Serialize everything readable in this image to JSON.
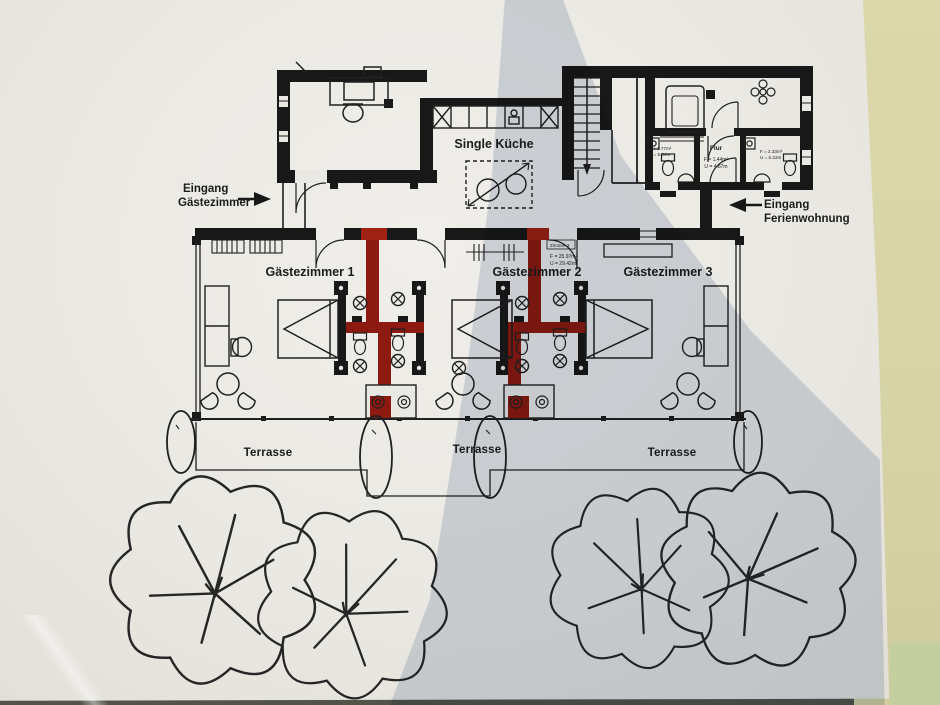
{
  "colors": {
    "paper": "#eae8e2",
    "wall": "#181818",
    "red_wall": "#8c1a10",
    "red_wall_bright": "#9e2113",
    "shadow_tint": "#b5c1d3",
    "table_background": "#d6d3a6"
  },
  "plan": {
    "kitchen_label": "Single Küche",
    "entrance_left": {
      "line1": "Eingang",
      "line2": "Gästezimmer"
    },
    "entrance_right": {
      "line1": "Eingang",
      "line2": "Ferienwohnung"
    },
    "rooms": [
      {
        "label": "Gästezimmer 1"
      },
      {
        "label": "Gästezimmer 2",
        "annotation": {
          "tag": "Zimmer 3",
          "area": "F = 25.97m²",
          "perimeter": "U = 29.42m"
        }
      },
      {
        "label": "Gästezimmer 3"
      }
    ],
    "terraces": [
      {
        "label": "Terrasse"
      },
      {
        "label": "Terrasse"
      },
      {
        "label": "Terrasse"
      }
    ],
    "wet_rooms": {
      "wc_left": {
        "label": "H-WC",
        "area": "F = 1.77m²",
        "perimeter": "U = 5.34m"
      },
      "hall": {
        "label": "Flur",
        "area": "F = 1.44m²",
        "perimeter": "U = 4.87m"
      },
      "wc_right": {
        "label": "D-WC",
        "area": "F = 2.33m²",
        "perimeter": "U = 6.22m"
      }
    }
  }
}
